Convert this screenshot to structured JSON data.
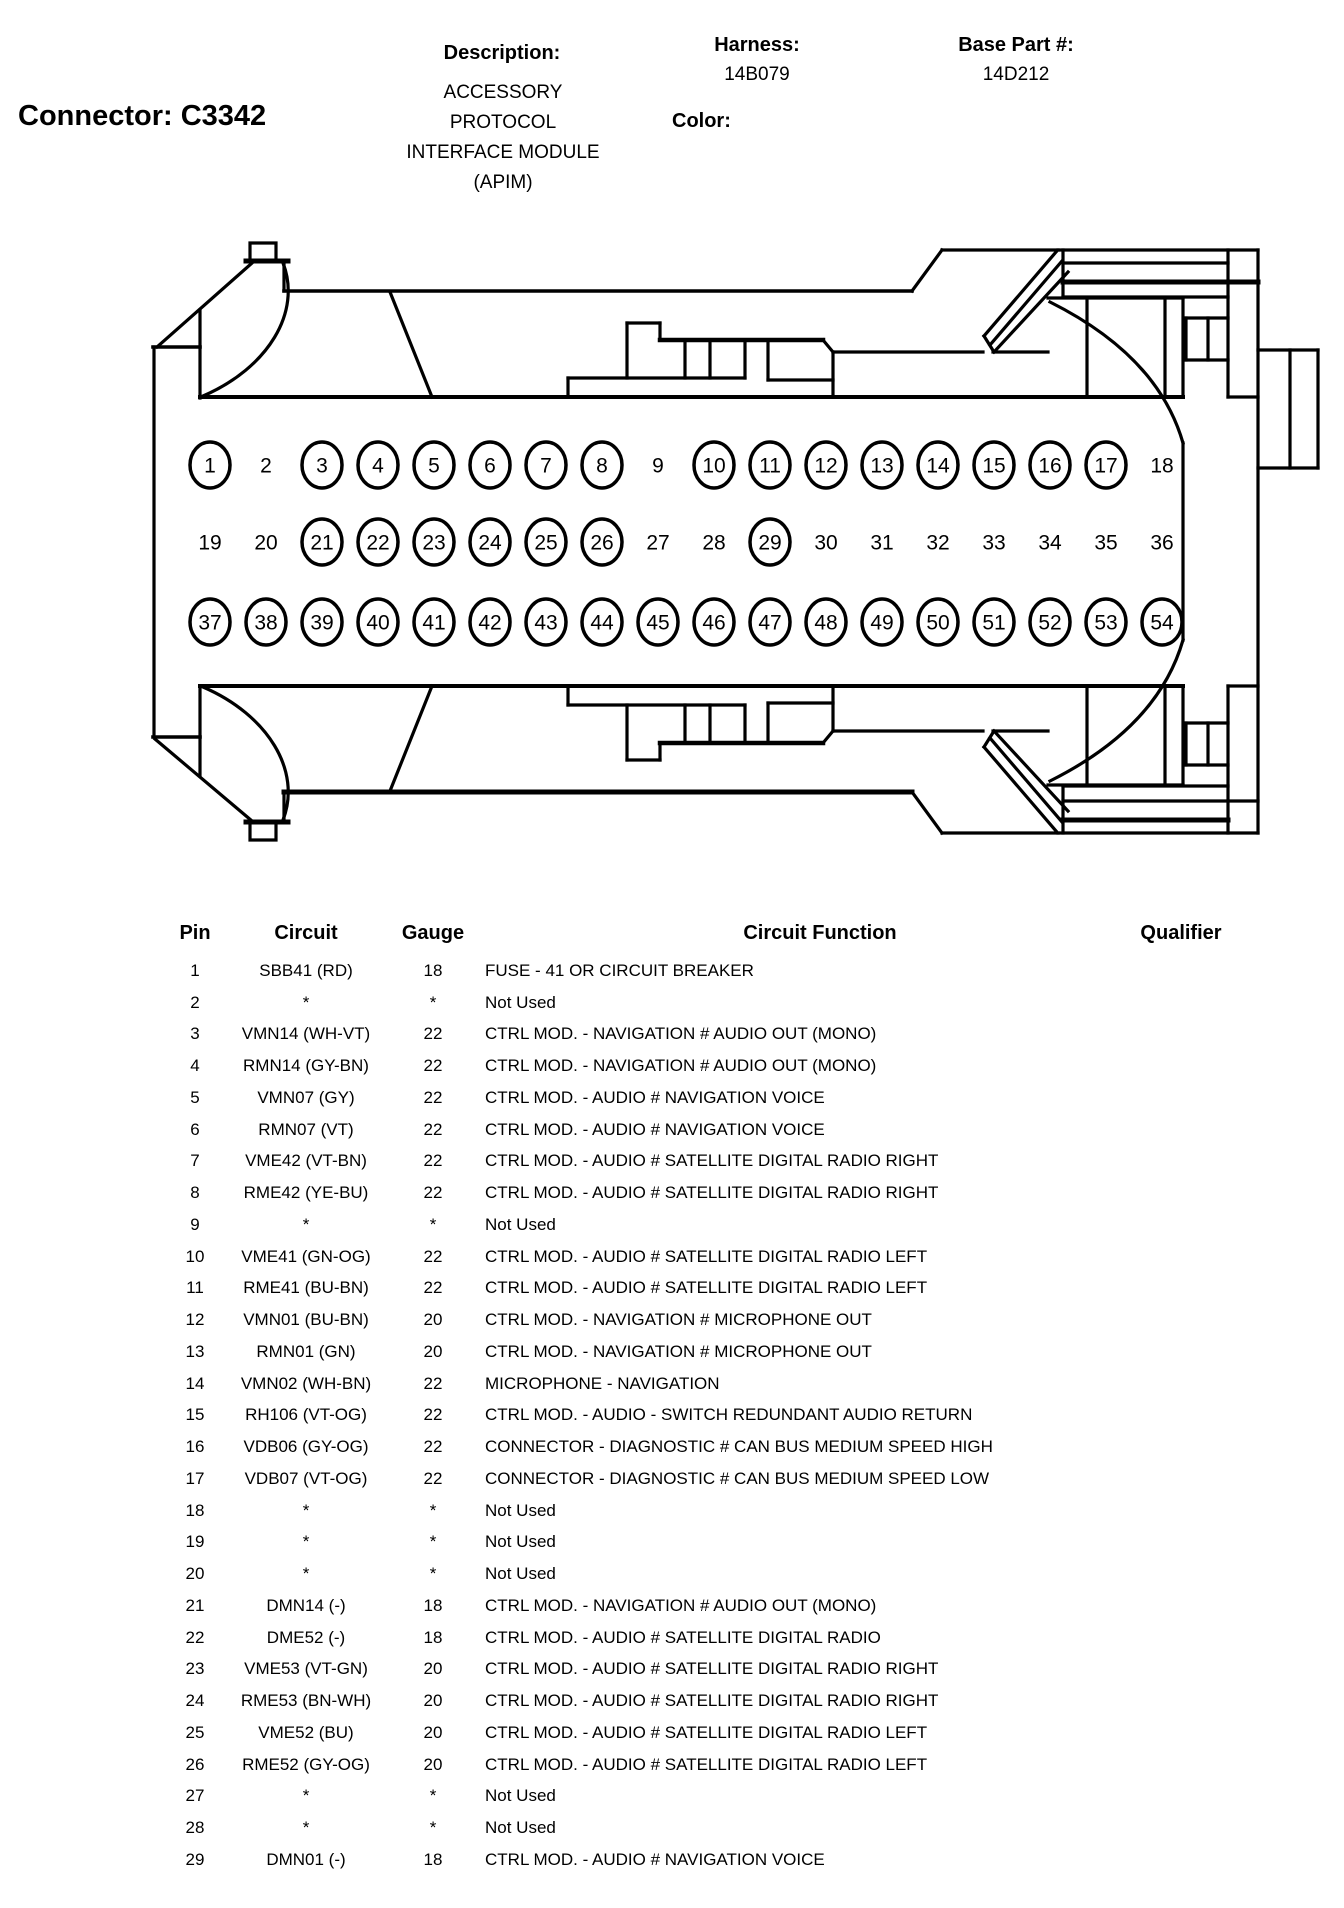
{
  "header": {
    "connector_label": "Connector: C3342",
    "description_label": "Description:",
    "description_lines": [
      "ACCESSORY",
      "PROTOCOL",
      "INTERFACE MODULE",
      "(APIM)"
    ],
    "color_label": "Color:",
    "color_value": "",
    "harness_label": "Harness:",
    "harness_value": "14B079",
    "base_part_label": "Base Part #:",
    "base_part_value": "14D212"
  },
  "diagram": {
    "pin_rows": [
      {
        "y": 465,
        "pins": [
          {
            "n": "1",
            "circled": true
          },
          {
            "n": "2",
            "circled": false
          },
          {
            "n": "3",
            "circled": true
          },
          {
            "n": "4",
            "circled": true
          },
          {
            "n": "5",
            "circled": true
          },
          {
            "n": "6",
            "circled": true
          },
          {
            "n": "7",
            "circled": true
          },
          {
            "n": "8",
            "circled": true
          },
          {
            "n": "9",
            "circled": false
          },
          {
            "n": "10",
            "circled": true
          },
          {
            "n": "11",
            "circled": true
          },
          {
            "n": "12",
            "circled": true
          },
          {
            "n": "13",
            "circled": true
          },
          {
            "n": "14",
            "circled": true
          },
          {
            "n": "15",
            "circled": true
          },
          {
            "n": "16",
            "circled": true
          },
          {
            "n": "17",
            "circled": true
          },
          {
            "n": "18",
            "circled": false
          }
        ]
      },
      {
        "y": 542,
        "pins": [
          {
            "n": "19",
            "circled": false
          },
          {
            "n": "20",
            "circled": false
          },
          {
            "n": "21",
            "circled": true
          },
          {
            "n": "22",
            "circled": true
          },
          {
            "n": "23",
            "circled": true
          },
          {
            "n": "24",
            "circled": true
          },
          {
            "n": "25",
            "circled": true
          },
          {
            "n": "26",
            "circled": true
          },
          {
            "n": "27",
            "circled": false
          },
          {
            "n": "28",
            "circled": false
          },
          {
            "n": "29",
            "circled": true
          },
          {
            "n": "30",
            "circled": false
          },
          {
            "n": "31",
            "circled": false
          },
          {
            "n": "32",
            "circled": false
          },
          {
            "n": "33",
            "circled": false
          },
          {
            "n": "34",
            "circled": false
          },
          {
            "n": "35",
            "circled": false
          },
          {
            "n": "36",
            "circled": false
          }
        ]
      },
      {
        "y": 622,
        "pins": [
          {
            "n": "37",
            "circled": true
          },
          {
            "n": "38",
            "circled": true
          },
          {
            "n": "39",
            "circled": true
          },
          {
            "n": "40",
            "circled": true
          },
          {
            "n": "41",
            "circled": true
          },
          {
            "n": "42",
            "circled": true
          },
          {
            "n": "43",
            "circled": true
          },
          {
            "n": "44",
            "circled": true
          },
          {
            "n": "45",
            "circled": true
          },
          {
            "n": "46",
            "circled": true
          },
          {
            "n": "47",
            "circled": true
          },
          {
            "n": "48",
            "circled": true
          },
          {
            "n": "49",
            "circled": true
          },
          {
            "n": "50",
            "circled": true
          },
          {
            "n": "51",
            "circled": true
          },
          {
            "n": "52",
            "circled": true
          },
          {
            "n": "53",
            "circled": true
          },
          {
            "n": "54",
            "circled": true
          }
        ]
      }
    ],
    "pin_start_x": 210,
    "pin_spacing": 56
  },
  "table": {
    "columns": {
      "pin": "Pin",
      "circuit": "Circuit",
      "gauge": "Gauge",
      "function": "Circuit Function",
      "qualifier": "Qualifier"
    },
    "rows": [
      {
        "pin": "1",
        "circuit": "SBB41 (RD)",
        "gauge": "18",
        "function": "FUSE - 41 OR CIRCUIT BREAKER",
        "qualifier": ""
      },
      {
        "pin": "2",
        "circuit": "*",
        "gauge": "*",
        "function": "Not Used",
        "qualifier": ""
      },
      {
        "pin": "3",
        "circuit": "VMN14 (WH-VT)",
        "gauge": "22",
        "function": "CTRL MOD. - NAVIGATION # AUDIO OUT (MONO)",
        "qualifier": ""
      },
      {
        "pin": "4",
        "circuit": "RMN14 (GY-BN)",
        "gauge": "22",
        "function": "CTRL MOD. - NAVIGATION # AUDIO OUT (MONO)",
        "qualifier": ""
      },
      {
        "pin": "5",
        "circuit": "VMN07 (GY)",
        "gauge": "22",
        "function": "CTRL MOD. - AUDIO # NAVIGATION VOICE",
        "qualifier": ""
      },
      {
        "pin": "6",
        "circuit": "RMN07 (VT)",
        "gauge": "22",
        "function": "CTRL MOD. - AUDIO # NAVIGATION VOICE",
        "qualifier": ""
      },
      {
        "pin": "7",
        "circuit": "VME42 (VT-BN)",
        "gauge": "22",
        "function": "CTRL MOD. - AUDIO # SATELLITE DIGITAL RADIO RIGHT",
        "qualifier": ""
      },
      {
        "pin": "8",
        "circuit": "RME42 (YE-BU)",
        "gauge": "22",
        "function": "CTRL MOD. - AUDIO # SATELLITE DIGITAL RADIO RIGHT",
        "qualifier": ""
      },
      {
        "pin": "9",
        "circuit": "*",
        "gauge": "*",
        "function": "Not Used",
        "qualifier": ""
      },
      {
        "pin": "10",
        "circuit": "VME41 (GN-OG)",
        "gauge": "22",
        "function": "CTRL MOD. - AUDIO # SATELLITE DIGITAL RADIO LEFT",
        "qualifier": ""
      },
      {
        "pin": "11",
        "circuit": "RME41 (BU-BN)",
        "gauge": "22",
        "function": "CTRL MOD. - AUDIO # SATELLITE DIGITAL RADIO LEFT",
        "qualifier": ""
      },
      {
        "pin": "12",
        "circuit": "VMN01 (BU-BN)",
        "gauge": "20",
        "function": "CTRL MOD. - NAVIGATION # MICROPHONE OUT",
        "qualifier": ""
      },
      {
        "pin": "13",
        "circuit": "RMN01 (GN)",
        "gauge": "20",
        "function": "CTRL MOD. - NAVIGATION # MICROPHONE OUT",
        "qualifier": ""
      },
      {
        "pin": "14",
        "circuit": "VMN02 (WH-BN)",
        "gauge": "22",
        "function": "MICROPHONE - NAVIGATION",
        "qualifier": ""
      },
      {
        "pin": "15",
        "circuit": "RH106 (VT-OG)",
        "gauge": "22",
        "function": "CTRL MOD. - AUDIO - SWITCH REDUNDANT AUDIO RETURN",
        "qualifier": ""
      },
      {
        "pin": "16",
        "circuit": "VDB06 (GY-OG)",
        "gauge": "22",
        "function": "CONNECTOR - DIAGNOSTIC # CAN BUS MEDIUM SPEED HIGH",
        "qualifier": ""
      },
      {
        "pin": "17",
        "circuit": "VDB07 (VT-OG)",
        "gauge": "22",
        "function": "CONNECTOR - DIAGNOSTIC # CAN BUS MEDIUM SPEED LOW",
        "qualifier": ""
      },
      {
        "pin": "18",
        "circuit": "*",
        "gauge": "*",
        "function": "Not Used",
        "qualifier": ""
      },
      {
        "pin": "19",
        "circuit": "*",
        "gauge": "*",
        "function": "Not Used",
        "qualifier": ""
      },
      {
        "pin": "20",
        "circuit": "*",
        "gauge": "*",
        "function": "Not Used",
        "qualifier": ""
      },
      {
        "pin": "21",
        "circuit": "DMN14 (-)",
        "gauge": "18",
        "function": "CTRL MOD. - NAVIGATION # AUDIO OUT (MONO)",
        "qualifier": ""
      },
      {
        "pin": "22",
        "circuit": "DME52 (-)",
        "gauge": "18",
        "function": "CTRL MOD. - AUDIO # SATELLITE DIGITAL RADIO",
        "qualifier": ""
      },
      {
        "pin": "23",
        "circuit": "VME53 (VT-GN)",
        "gauge": "20",
        "function": "CTRL MOD. - AUDIO # SATELLITE DIGITAL RADIO RIGHT",
        "qualifier": ""
      },
      {
        "pin": "24",
        "circuit": "RME53 (BN-WH)",
        "gauge": "20",
        "function": "CTRL MOD. - AUDIO # SATELLITE DIGITAL RADIO RIGHT",
        "qualifier": ""
      },
      {
        "pin": "25",
        "circuit": "VME52 (BU)",
        "gauge": "20",
        "function": "CTRL MOD. - AUDIO # SATELLITE DIGITAL RADIO LEFT",
        "qualifier": ""
      },
      {
        "pin": "26",
        "circuit": "RME52 (GY-OG)",
        "gauge": "20",
        "function": "CTRL MOD. - AUDIO # SATELLITE DIGITAL RADIO LEFT",
        "qualifier": ""
      },
      {
        "pin": "27",
        "circuit": "*",
        "gauge": "*",
        "function": "Not Used",
        "qualifier": ""
      },
      {
        "pin": "28",
        "circuit": "*",
        "gauge": "*",
        "function": "Not Used",
        "qualifier": ""
      },
      {
        "pin": "29",
        "circuit": "DMN01 (-)",
        "gauge": "18",
        "function": "CTRL MOD. - AUDIO # NAVIGATION VOICE",
        "qualifier": ""
      }
    ]
  }
}
